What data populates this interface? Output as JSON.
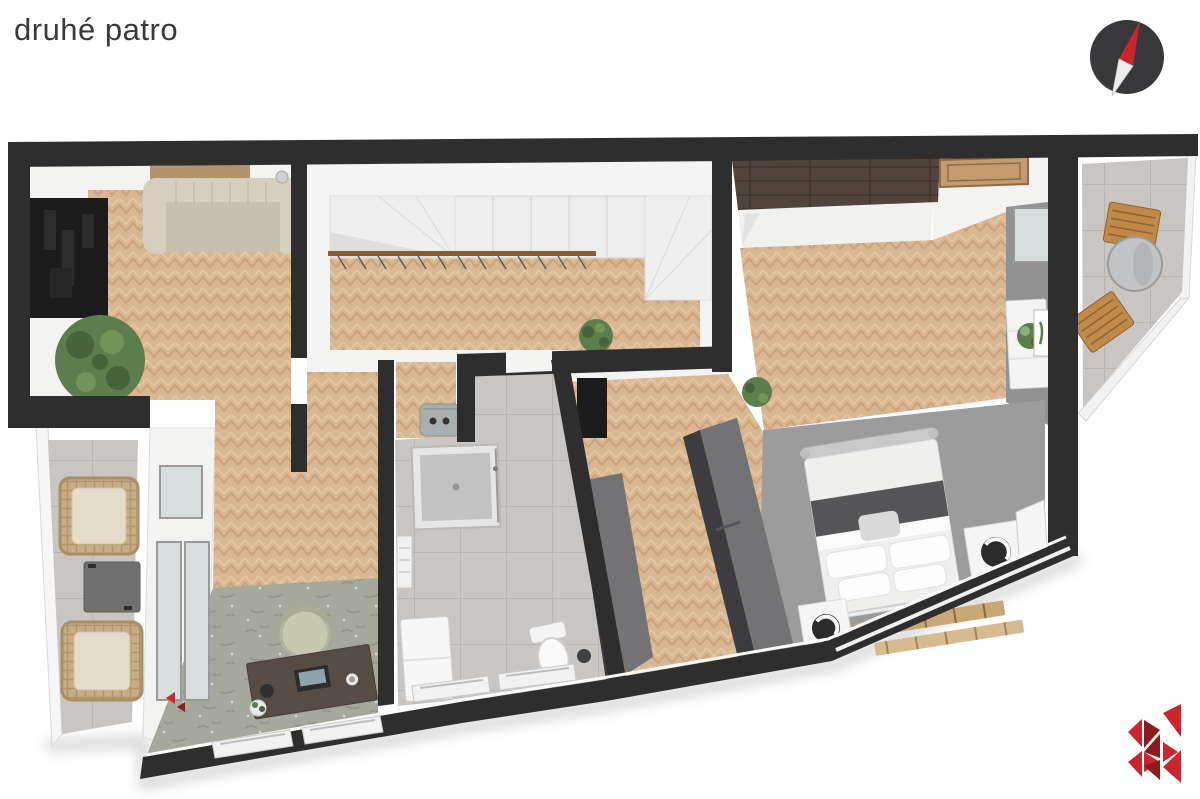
{
  "header": {
    "title": "druhé patro",
    "title_color": "#3a3a3a"
  },
  "compass": {
    "icon": "compass-icon",
    "body_color": "#38383a",
    "north_needle_color": "#c1272d",
    "south_needle_color": "#ededed"
  },
  "logo": {
    "icon": "brand-k-logo",
    "color": "#c9252b",
    "color_dark": "#8e1b1f"
  },
  "palette": {
    "bg": "#ffffff",
    "wall": "#2e2e2f",
    "wall_face": "#f3f3f2",
    "gray_wall_face": "#929292",
    "wood": "#d9b793",
    "wood_line": "#c79e75",
    "wood_line2": "#e6c9a4",
    "wood_dark": "#52443a",
    "tile": "#c8c5c2",
    "tile_line": "#b7b4b1",
    "carpet": "#9c9c9c",
    "stone": "#a7a89c",
    "stone_dark": "#8f9083",
    "dark_obj": "#1b1b1b",
    "sofa": "#d6cec0",
    "sofa_seat": "#c7bfb0",
    "plant": "#5c7d4c",
    "plant_dark": "#46633a",
    "wood_rail": "#8a5a33",
    "accent_red": "#c9252b",
    "accent_red_dark": "#8e1b1f",
    "compass_body": "#38383a",
    "needle_white": "#ededed",
    "shadow": "#bcbcbc"
  },
  "scene": {
    "type": "3d-floor-plan-render",
    "floor": "druhé patro",
    "rooms": [
      "living-room",
      "staircase-hall",
      "corridor",
      "bathroom",
      "walk-in-closet",
      "bedroom",
      "office",
      "balcony-left",
      "balcony-right"
    ]
  }
}
